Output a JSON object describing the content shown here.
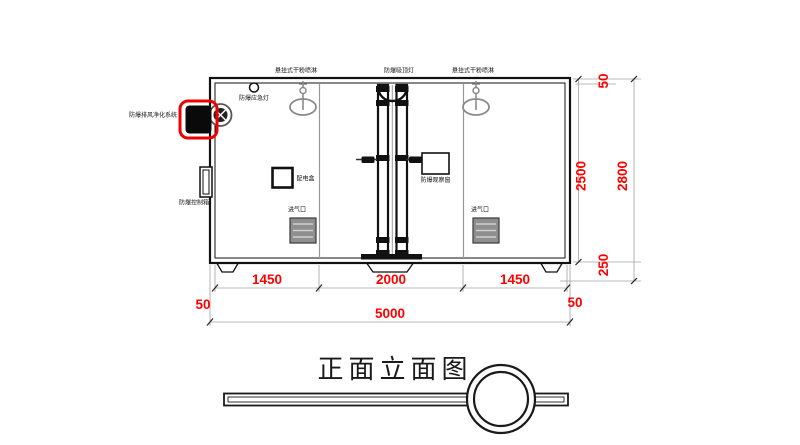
{
  "drawing": {
    "title": "正面立面图",
    "component_labels": {
      "sprinkler_left": "悬挂式干粉喷淋",
      "ceiling_lamp": "防爆吸顶灯",
      "sprinkler_right": "悬挂式干粉喷淋",
      "emergency_lamp": "防爆应急灯",
      "purification_system": "防爆排风净化系统",
      "control_box": "防爆控制箱",
      "power_box": "配电盒",
      "observation_window": "防爆观察窗",
      "air_inlet_left": "进气口",
      "air_inlet_right": "进气口"
    },
    "dimensions": {
      "bay_left": "1450",
      "bay_center": "2000",
      "bay_right": "1450",
      "wall_left": "50",
      "overall_width": "5000",
      "wall_right": "50",
      "inner_height": "2500",
      "roof_thickness": "50",
      "overall_height": "2800",
      "base_height": "250"
    },
    "colors": {
      "dimension_text": "#FF0000",
      "fan_unit_highlight": "#FF0000",
      "line_primary": "#000000",
      "line_secondary": "#8C8C8C",
      "background": "#FFFFFF"
    }
  }
}
